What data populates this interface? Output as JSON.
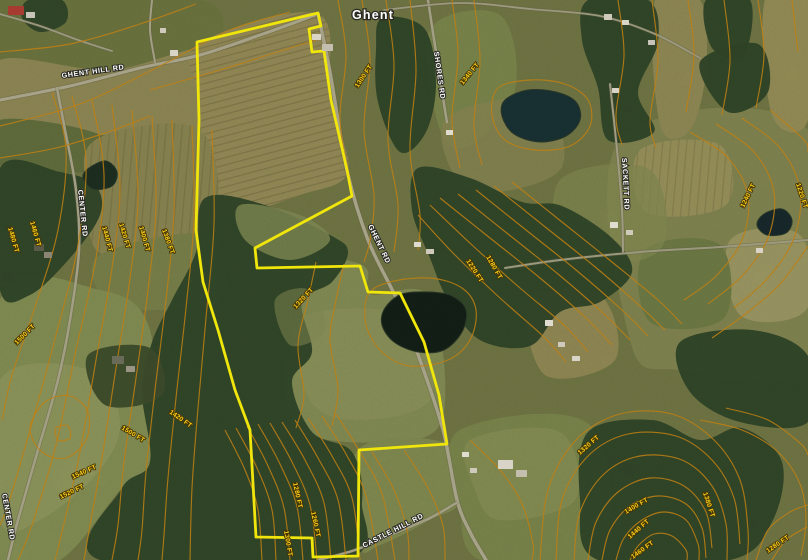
{
  "map": {
    "town": {
      "label": "Ghent"
    },
    "road_labels": [
      {
        "name": "ghent-hill-rd",
        "text": "GHENT HILL RD",
        "x": 62,
        "y": 78,
        "rot": -8
      },
      {
        "name": "shores-rd",
        "text": "SHORES RD",
        "x": 434,
        "y": 52,
        "rot": 82
      },
      {
        "name": "ghent-rd",
        "text": "GHENT RD",
        "x": 368,
        "y": 226,
        "rot": 64
      },
      {
        "name": "center-rd",
        "text": "CENTER RD",
        "x": 78,
        "y": 190,
        "rot": 84
      },
      {
        "name": "center-rd-south",
        "text": "CENTER RD",
        "x": 2,
        "y": 494,
        "rot": 80
      },
      {
        "name": "sackett-rd",
        "text": "SACKETT RD",
        "x": 622,
        "y": 158,
        "rot": 87
      },
      {
        "name": "castle-hill-rd",
        "text": "CASTLE HILL RD",
        "x": 364,
        "y": 548,
        "rot": -27
      }
    ],
    "elevation_labels": [
      {
        "text": "1300 FT",
        "x": 358,
        "y": 88,
        "rot": -56
      },
      {
        "text": "1340 FT",
        "x": 463,
        "y": 85,
        "rot": -51
      },
      {
        "text": "1440 FT",
        "x": 102,
        "y": 227,
        "rot": 75
      },
      {
        "text": "1420 FT",
        "x": 119,
        "y": 224,
        "rot": 73
      },
      {
        "text": "1400 FT",
        "x": 139,
        "y": 227,
        "rot": 74
      },
      {
        "text": "1380 FT",
        "x": 162,
        "y": 230,
        "rot": 70
      },
      {
        "text": "1460 FT",
        "x": 30,
        "y": 222,
        "rot": 74
      },
      {
        "text": "1480 FT",
        "x": 8,
        "y": 228,
        "rot": 74
      },
      {
        "text": "1500 FT",
        "x": 17,
        "y": 345,
        "rot": -45
      },
      {
        "text": "1320 FT",
        "x": 296,
        "y": 309,
        "rot": -47
      },
      {
        "text": "1220 FT",
        "x": 466,
        "y": 261,
        "rot": 57
      },
      {
        "text": "1280 FT",
        "x": 486,
        "y": 257,
        "rot": 60
      },
      {
        "text": "1240 FT",
        "x": 744,
        "y": 208,
        "rot": -64
      },
      {
        "text": "1220 FT",
        "x": 796,
        "y": 184,
        "rot": 72
      },
      {
        "text": "1420 FT",
        "x": 169,
        "y": 413,
        "rot": 35
      },
      {
        "text": "1500 FT",
        "x": 121,
        "y": 429,
        "rot": 31
      },
      {
        "text": "1540 FT",
        "x": 73,
        "y": 479,
        "rot": -24
      },
      {
        "text": "1520 FT",
        "x": 61,
        "y": 499,
        "rot": -26
      },
      {
        "text": "1280 FT",
        "x": 293,
        "y": 483,
        "rot": 78
      },
      {
        "text": "1260 FT",
        "x": 311,
        "y": 512,
        "rot": 78
      },
      {
        "text": "1300 FT",
        "x": 284,
        "y": 531,
        "rot": 80
      },
      {
        "text": "1320 FT",
        "x": 580,
        "y": 455,
        "rot": -41
      },
      {
        "text": "1400 FT",
        "x": 626,
        "y": 514,
        "rot": -30
      },
      {
        "text": "1440 FT",
        "x": 630,
        "y": 539,
        "rot": -41
      },
      {
        "text": "1460 FT",
        "x": 633,
        "y": 559,
        "rot": -36
      },
      {
        "text": "1380 FT",
        "x": 703,
        "y": 493,
        "rot": 72
      },
      {
        "text": "1280 FT",
        "x": 768,
        "y": 553,
        "rot": -34
      }
    ],
    "colors": {
      "boundary": "#f0e60b",
      "contour": "#bd7f13",
      "elevation_text": "#ffd21d",
      "road_text": "#ffffff"
    }
  }
}
